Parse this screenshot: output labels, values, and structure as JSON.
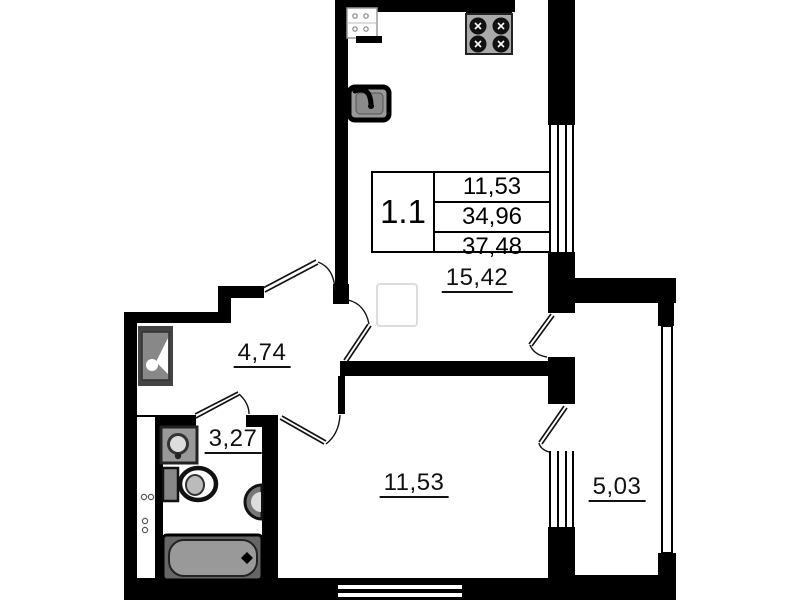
{
  "plan": {
    "unit": {
      "label": "1.1"
    },
    "info_table": {
      "values": [
        "11,53",
        "34,96",
        "37,48"
      ]
    },
    "rooms": [
      {
        "name": "kitchen-living-room",
        "area": "15,42"
      },
      {
        "name": "hallway",
        "area": "4,74"
      },
      {
        "name": "bathroom",
        "area": "3,27"
      },
      {
        "name": "bedroom",
        "area": "11,53"
      },
      {
        "name": "balcony",
        "area": "5,03"
      }
    ],
    "fixtures": [
      "counter-appliance",
      "stove",
      "kitchen-sink",
      "hallway-washbasin",
      "bathroom-washbasin",
      "toilet",
      "water-heater",
      "bathtub",
      "vent-shaft"
    ],
    "colors": {
      "wall": "#000000",
      "fixture_dark": "#444444",
      "fixture_gray": "#999999",
      "background": "#ffffff",
      "label": "#111111"
    }
  }
}
